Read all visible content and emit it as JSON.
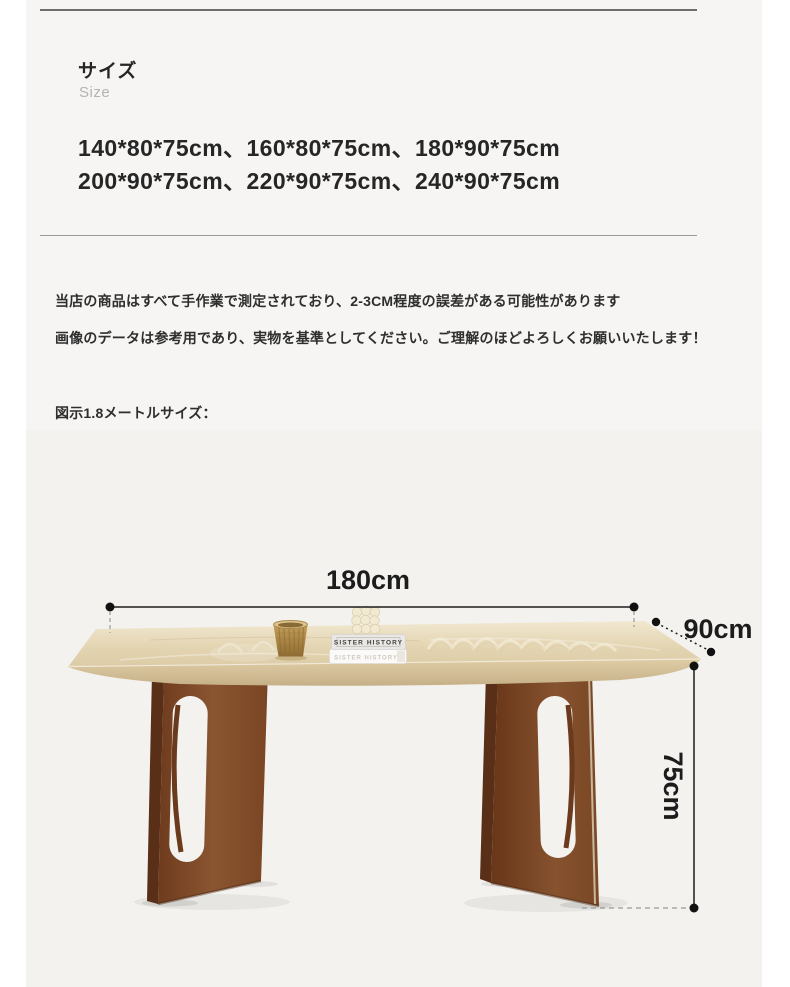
{
  "header": {
    "title": "サイズ",
    "subtitle": "Size"
  },
  "sizes": {
    "line1": "140*80*75cm、160*80*75cm、180*90*75cm",
    "line2": "200*90*75cm、220*90*75cm、240*90*75cm"
  },
  "notes": {
    "line1": "当店の商品はすべて手作業で測定されており、2-3CM程度の誤差がある可能性があります",
    "line2": "画像のデータは参考用であり、実物を基準としてください。ご理解のほどよろしくお願いいたします！"
  },
  "figure_caption": "図示1.8メートルサイズ：",
  "diagram": {
    "width_label": "180cm",
    "depth_label": "90cm",
    "height_label": "75cm",
    "book_spine": "SISTER HISTORY",
    "book_spine_faint": "SISTER HISTORY",
    "colors": {
      "panel_background": "#f6f5f3",
      "photo_background": "#f3f2ef",
      "tabletop": "#e6d8b5",
      "wood": "#7c4726",
      "dimension_line": "#1c1c1c",
      "guide_dash": "#9a9a9a"
    }
  }
}
